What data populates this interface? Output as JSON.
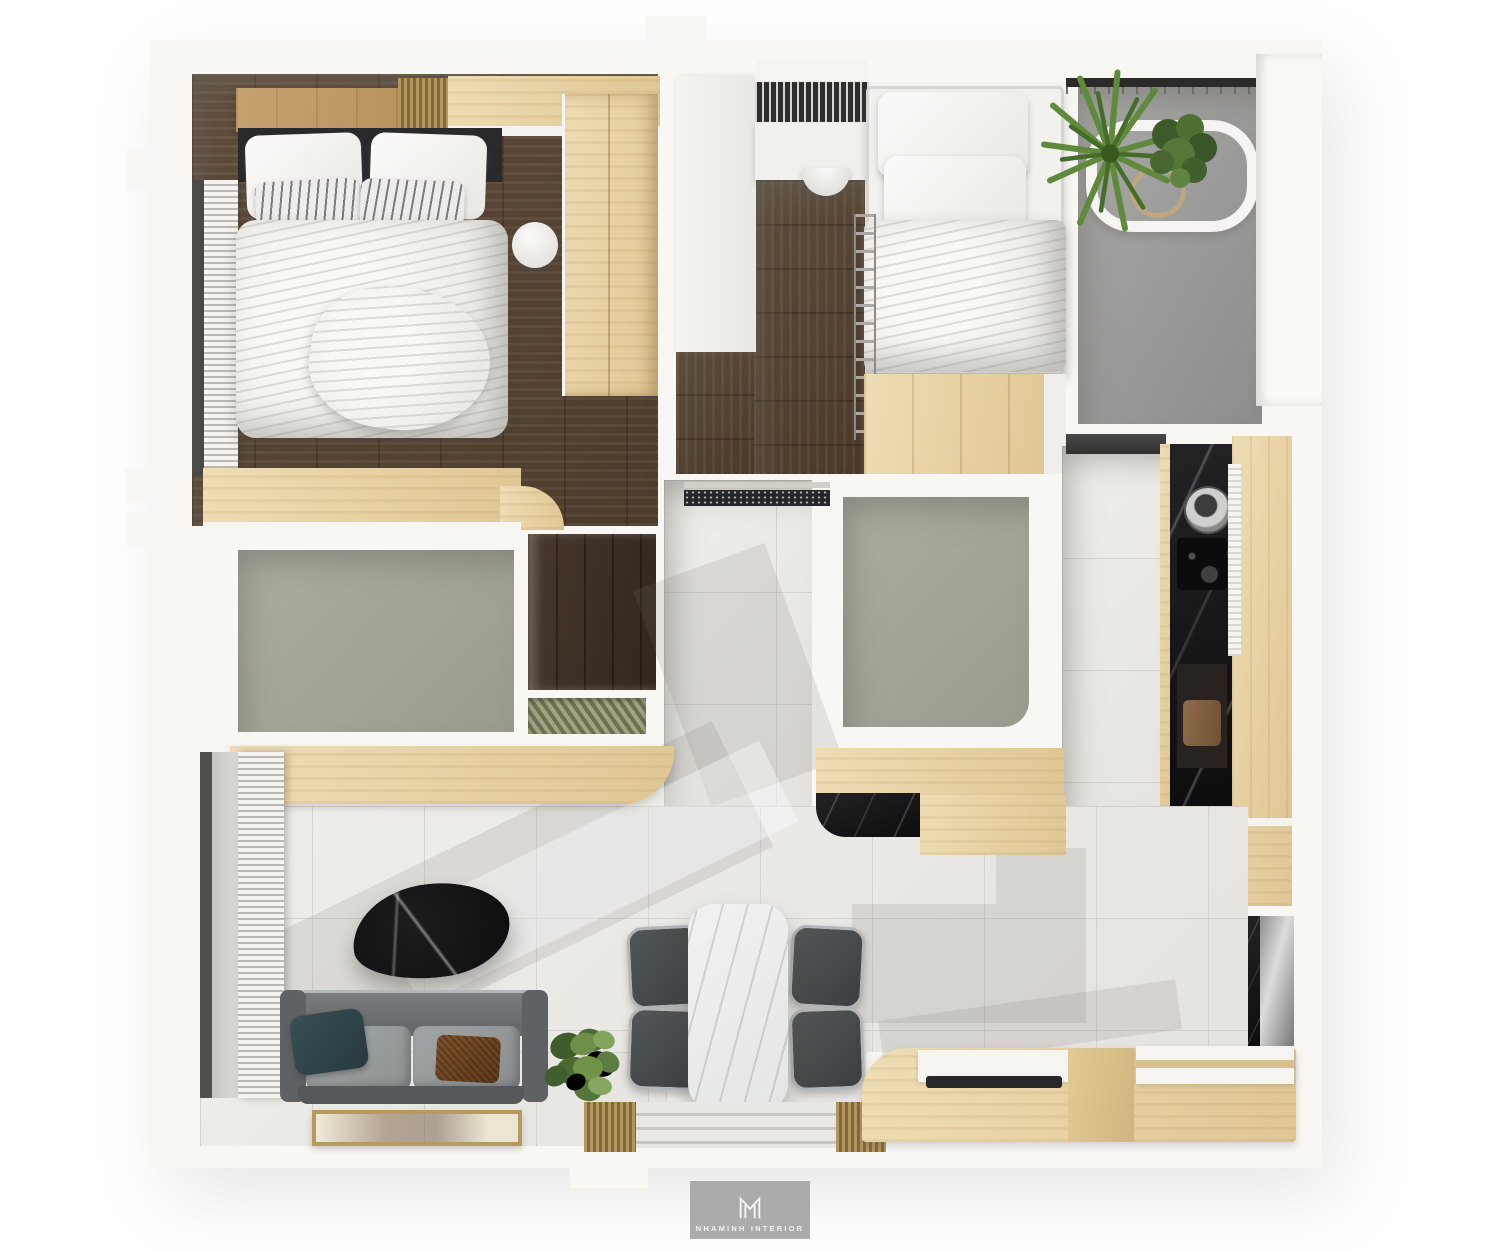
{
  "render": {
    "kind": "3D top-down apartment floor plan interior render",
    "watermark": {
      "monogram": "M",
      "studio": "NHAMINH INTERIOR"
    },
    "palette": {
      "page_bg": "#ffffff",
      "walls": "#f8f7f4",
      "dark_wood_floor": "#5d4936",
      "light_wood": "#e7d4a8",
      "tile_floor": "#eae8e4",
      "bathroom_floor": "#a6a599",
      "balcony_floor": "#9c9c9a",
      "black_marble": "#141417",
      "white_marble": "#ebecec",
      "sofa_gray": "#737678",
      "pillow_teal": "#31454a",
      "pillow_brown": "#744a27",
      "plant_green": "#55783a",
      "logo_gray": "#ababab"
    },
    "rooms": [
      {
        "name": "master-bedroom",
        "floor": "dark wood",
        "items": [
          "double bed with white duvet",
          "two white pillows",
          "two striped pillows",
          "black headboard",
          "wood headboard shelf",
          "slatted wood panel",
          "tall wardrobe",
          "round white pouf",
          "venetian blinds window",
          "corner desk counter"
        ]
      },
      {
        "name": "second-bedroom",
        "floor": "dark wood",
        "items": [
          "single bed with white bedding",
          "stacked white pillows",
          "white desk",
          "tucked chair",
          "wardrobe hanging rail",
          "light wood platform",
          "side rail ladder"
        ]
      },
      {
        "name": "balcony",
        "floor": "gray concrete",
        "items": [
          "dark railing",
          "white planter shelf",
          "agave plant",
          "shrub plant",
          "hose coil"
        ]
      },
      {
        "name": "bathroom-left",
        "floor": "gray screed",
        "items": []
      },
      {
        "name": "bathroom-middle",
        "floor": "gray screed",
        "items": []
      },
      {
        "name": "entry-hall",
        "floor": "light gray tile",
        "items": [
          "entry door",
          "speckled doormat",
          "dark storage closet",
          "slatted niche"
        ]
      },
      {
        "name": "kitchen",
        "floor": "light gray tile",
        "items": [
          "black marble counter",
          "round steel sink",
          "black cooktop",
          "range hood",
          "cutting board",
          "tall light wood cabinets",
          "mirror front fridge"
        ]
      },
      {
        "name": "living-room",
        "floor": "light gray tile",
        "items": [
          "gray velvet sofa",
          "teal cushion",
          "brown woven cushion",
          "black marble coffee table",
          "light wood tv console",
          "framed artwork mat",
          "potted plant",
          "venetian blinds window"
        ]
      },
      {
        "name": "dining-area",
        "floor": "light gray tile",
        "items": [
          "white marble dining table",
          "four gray chairs",
          "potted plant",
          "wood storage bench",
          "slatted door threshold"
        ]
      }
    ],
    "counts": {
      "bedrooms": 2,
      "bathrooms": 2,
      "dining_chairs": 4,
      "plants": 4,
      "sofas": 1,
      "beds": 2
    }
  }
}
